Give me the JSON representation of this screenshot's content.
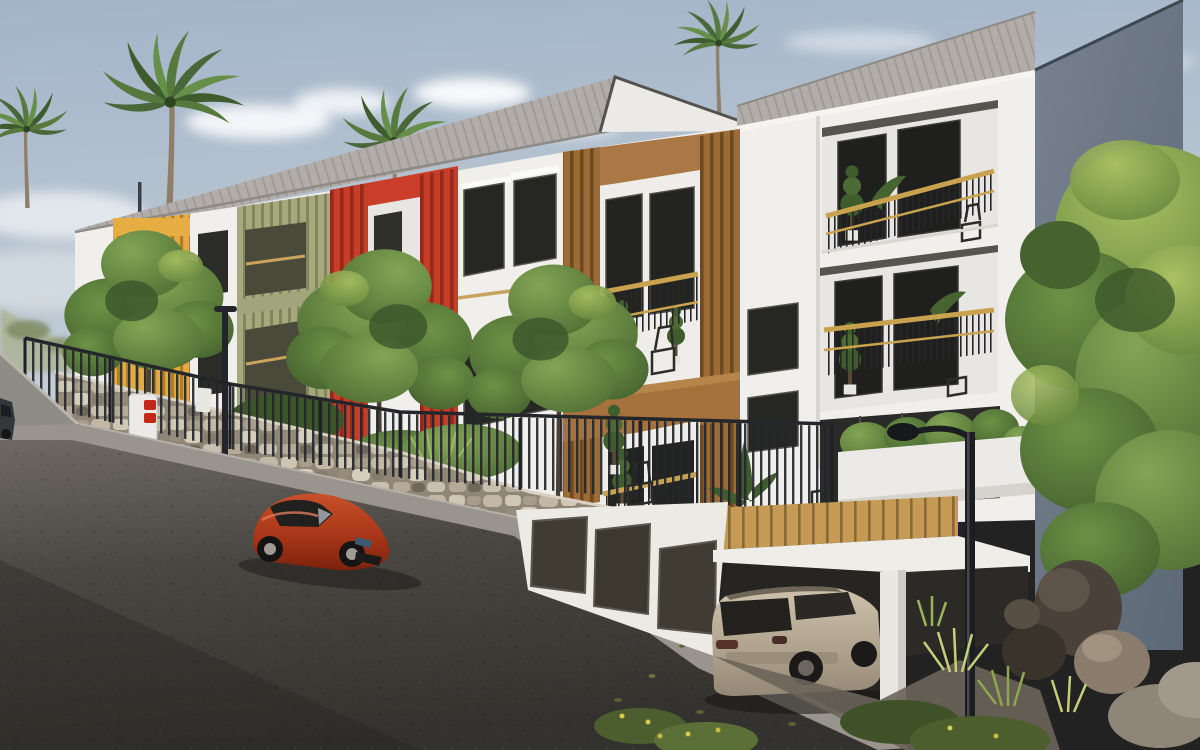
{
  "scene": {
    "description": "3D architectural rendering of a modern three-storey apartment residence on a sloping street, daytime, tropical setting",
    "time_of_day": "day",
    "style": "photoreal exterior visualization"
  },
  "palette": {
    "sky_top": "#a3b4c9",
    "sky_bottom": "#ccd4da",
    "roof_gray": "#b3adaa",
    "wall_white": "#f1efec",
    "gable_side_blue_gray": "#6e7987",
    "accent_yellow": "#e3ab45",
    "accent_olive": "#a6a87e",
    "accent_red": "#c63d28",
    "accent_wood": "#a5713c",
    "rail_gold": "#c9a24f",
    "stone_wall": "#b0a595",
    "fence_black": "#23262a",
    "asphalt_dark": "#35332f",
    "sidewalk_gray": "#99948d",
    "red_car": "#b03a1e",
    "suv_champagne": "#b7aa95",
    "foliage_green": "#5f8141",
    "rock_dark": "#4a423a"
  },
  "objects": [
    {
      "id": "sky",
      "label": "overcast-blue sky with soft clouds"
    },
    {
      "id": "palm-trees",
      "label": "four coconut palm trees behind and beside the building"
    },
    {
      "id": "apartment-building",
      "label": "white three-storey apartment block with colored balcony volumes"
    },
    {
      "id": "yellow-balcony-box",
      "label": "yellow slatted balcony volume"
    },
    {
      "id": "olive-facade-section",
      "label": "olive-green slatted facade section"
    },
    {
      "id": "red-balcony-box",
      "label": "red slatted balcony volume"
    },
    {
      "id": "wood-balcony-box",
      "label": "timber slatted double balcony volume"
    },
    {
      "id": "gable-block",
      "label": "right gable block with recessed gold-railing balconies"
    },
    {
      "id": "stone-retaining-wall",
      "label": "natural stone retaining wall along sidewalk"
    },
    {
      "id": "metal-fence",
      "label": "black vertical-bar fence on top of wall"
    },
    {
      "id": "street",
      "label": "dark asphalt street sloping downhill"
    },
    {
      "id": "red-car",
      "label": "red coupe parked on the street"
    },
    {
      "id": "suv",
      "label": "champagne SUV parked in open garage bay"
    },
    {
      "id": "garage-podium",
      "label": "white garage podium with dark doors and carport deck"
    },
    {
      "id": "street-lamp",
      "label": "black curved street lamp in foreground"
    },
    {
      "id": "no-entry-totem",
      "label": "white totem with two red traffic signs"
    },
    {
      "id": "green-trees",
      "label": "deciduous street trees and shrubs"
    },
    {
      "id": "rocks",
      "label": "landscape boulders among grasses at lower right"
    }
  ]
}
